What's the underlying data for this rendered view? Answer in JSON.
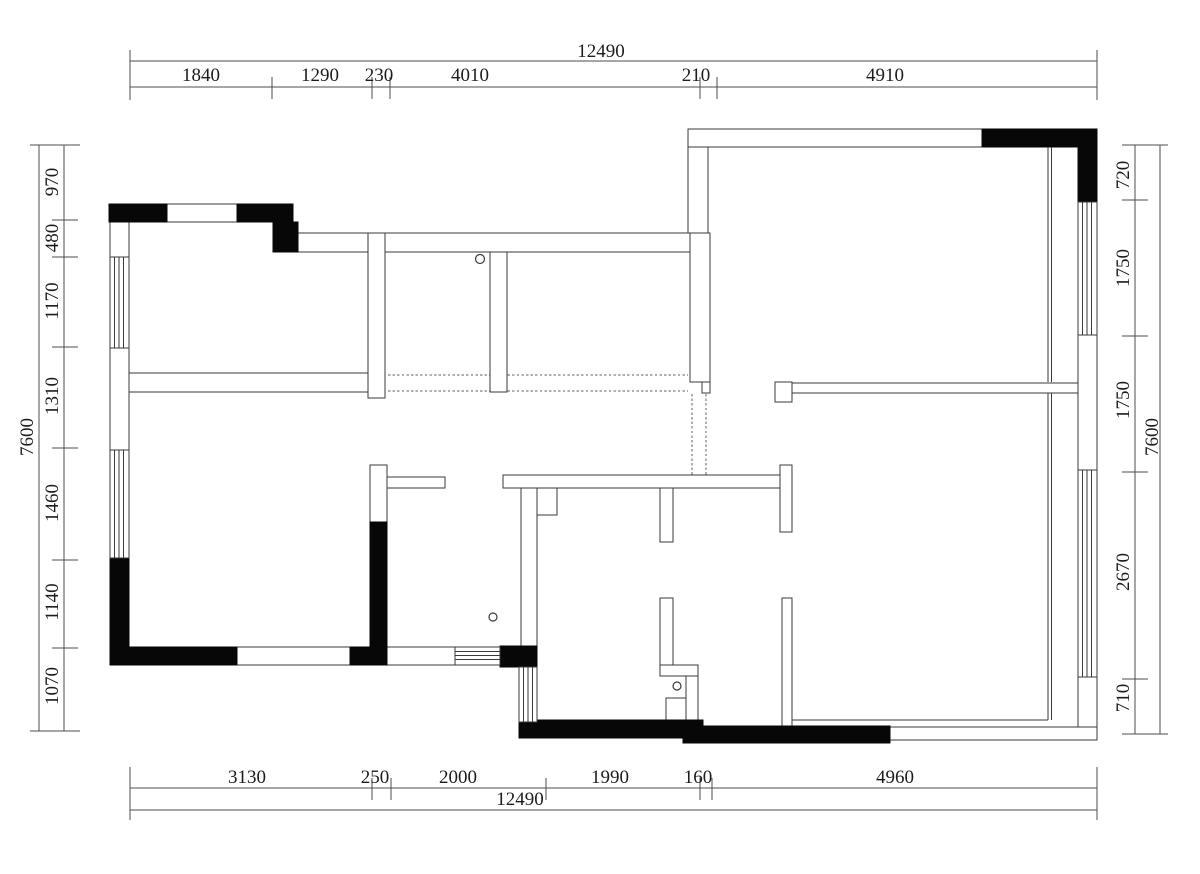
{
  "page": {
    "title": "Apartment floor plan with dimension chains"
  },
  "colors": {
    "background": "#ffffff",
    "wall_line": "#3a3a3a",
    "solid_wall_fill": "#070707",
    "dimension_line": "#4d4d4d",
    "dimension_text": "#1c1c1c",
    "dashed_opening_line": "#5f5f5f"
  },
  "dimensions": {
    "top": {
      "overall": "12490",
      "segments": [
        "1840",
        "1290",
        "230",
        "4010",
        "210",
        "4910"
      ]
    },
    "bottom": {
      "overall": "12490",
      "segments": [
        "3130",
        "250",
        "2000",
        "1990",
        "160",
        "4960"
      ]
    },
    "left": {
      "overall": "7600",
      "segments": [
        "970",
        "480",
        "1170",
        "1310",
        "1460",
        "1140",
        "1070"
      ]
    },
    "right": {
      "overall": "7600",
      "segments": [
        "720",
        "1750",
        "1750",
        "2670",
        "710"
      ]
    }
  },
  "symbols": {
    "circle_markers": 3,
    "window_hatches": 5,
    "door_threshold_hatches": 1
  }
}
